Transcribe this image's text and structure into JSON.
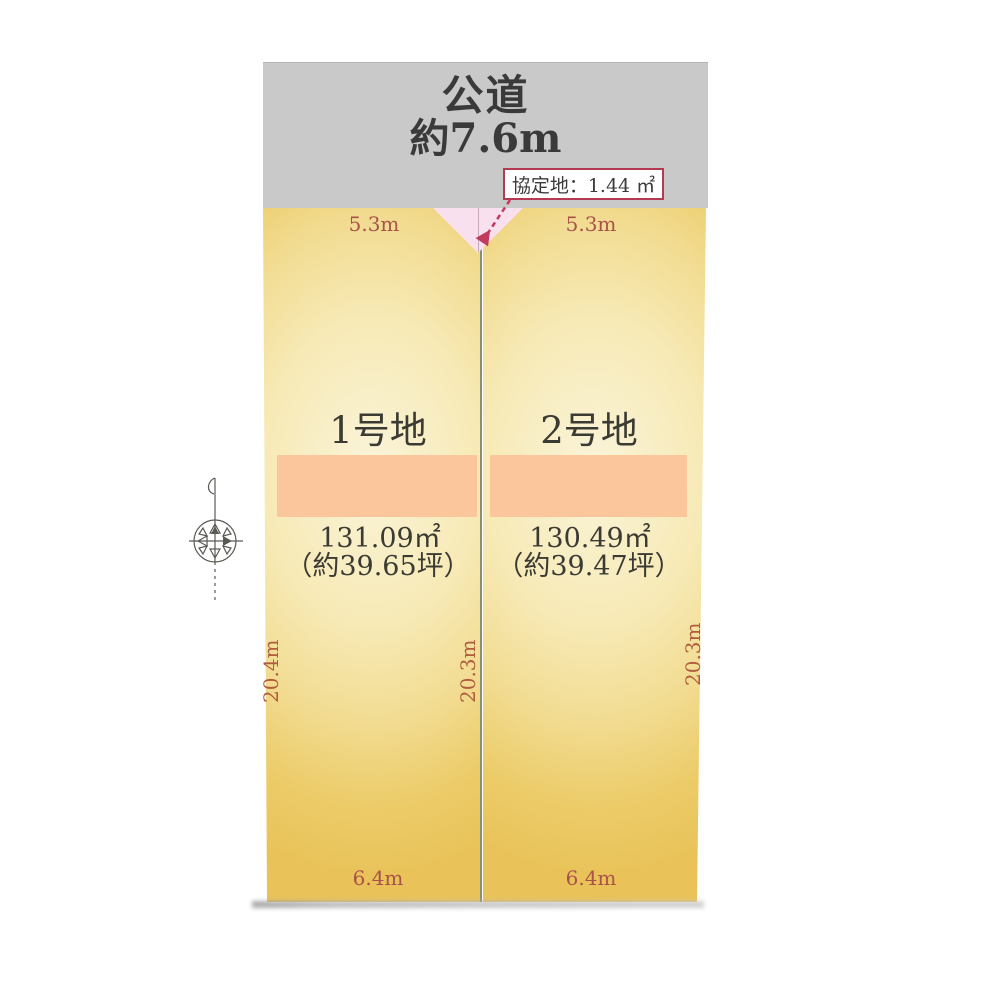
{
  "diagram": {
    "title": "土地区画図",
    "road": {
      "name": "公道",
      "width": "約7.6m"
    },
    "agreement": {
      "label": "協定地：1.44 ㎡"
    },
    "lots": [
      {
        "name": "1号地",
        "area_m2": "131.09㎡",
        "area_tsubo": "（約39.65坪）",
        "frontage": "5.3m",
        "bottom": "6.4m",
        "side_left": "20.4m",
        "side_right": "20.3m"
      },
      {
        "name": "2号地",
        "area_m2": "130.49㎡",
        "area_tsubo": "（約39.47坪）",
        "frontage": "5.3m",
        "bottom": "6.4m",
        "side_right": "20.3m"
      }
    ],
    "colors": {
      "road_fill": "#c9c9c9",
      "lot_edge": "#e9c35a",
      "lot_center": "#faf4da",
      "highlight_fill": "#fbc69c",
      "dimension_text": "#a8524a",
      "callout_border": "#b23a52",
      "agreement_fill": "#f9e0ee",
      "divider": "#8d8d6f"
    }
  }
}
